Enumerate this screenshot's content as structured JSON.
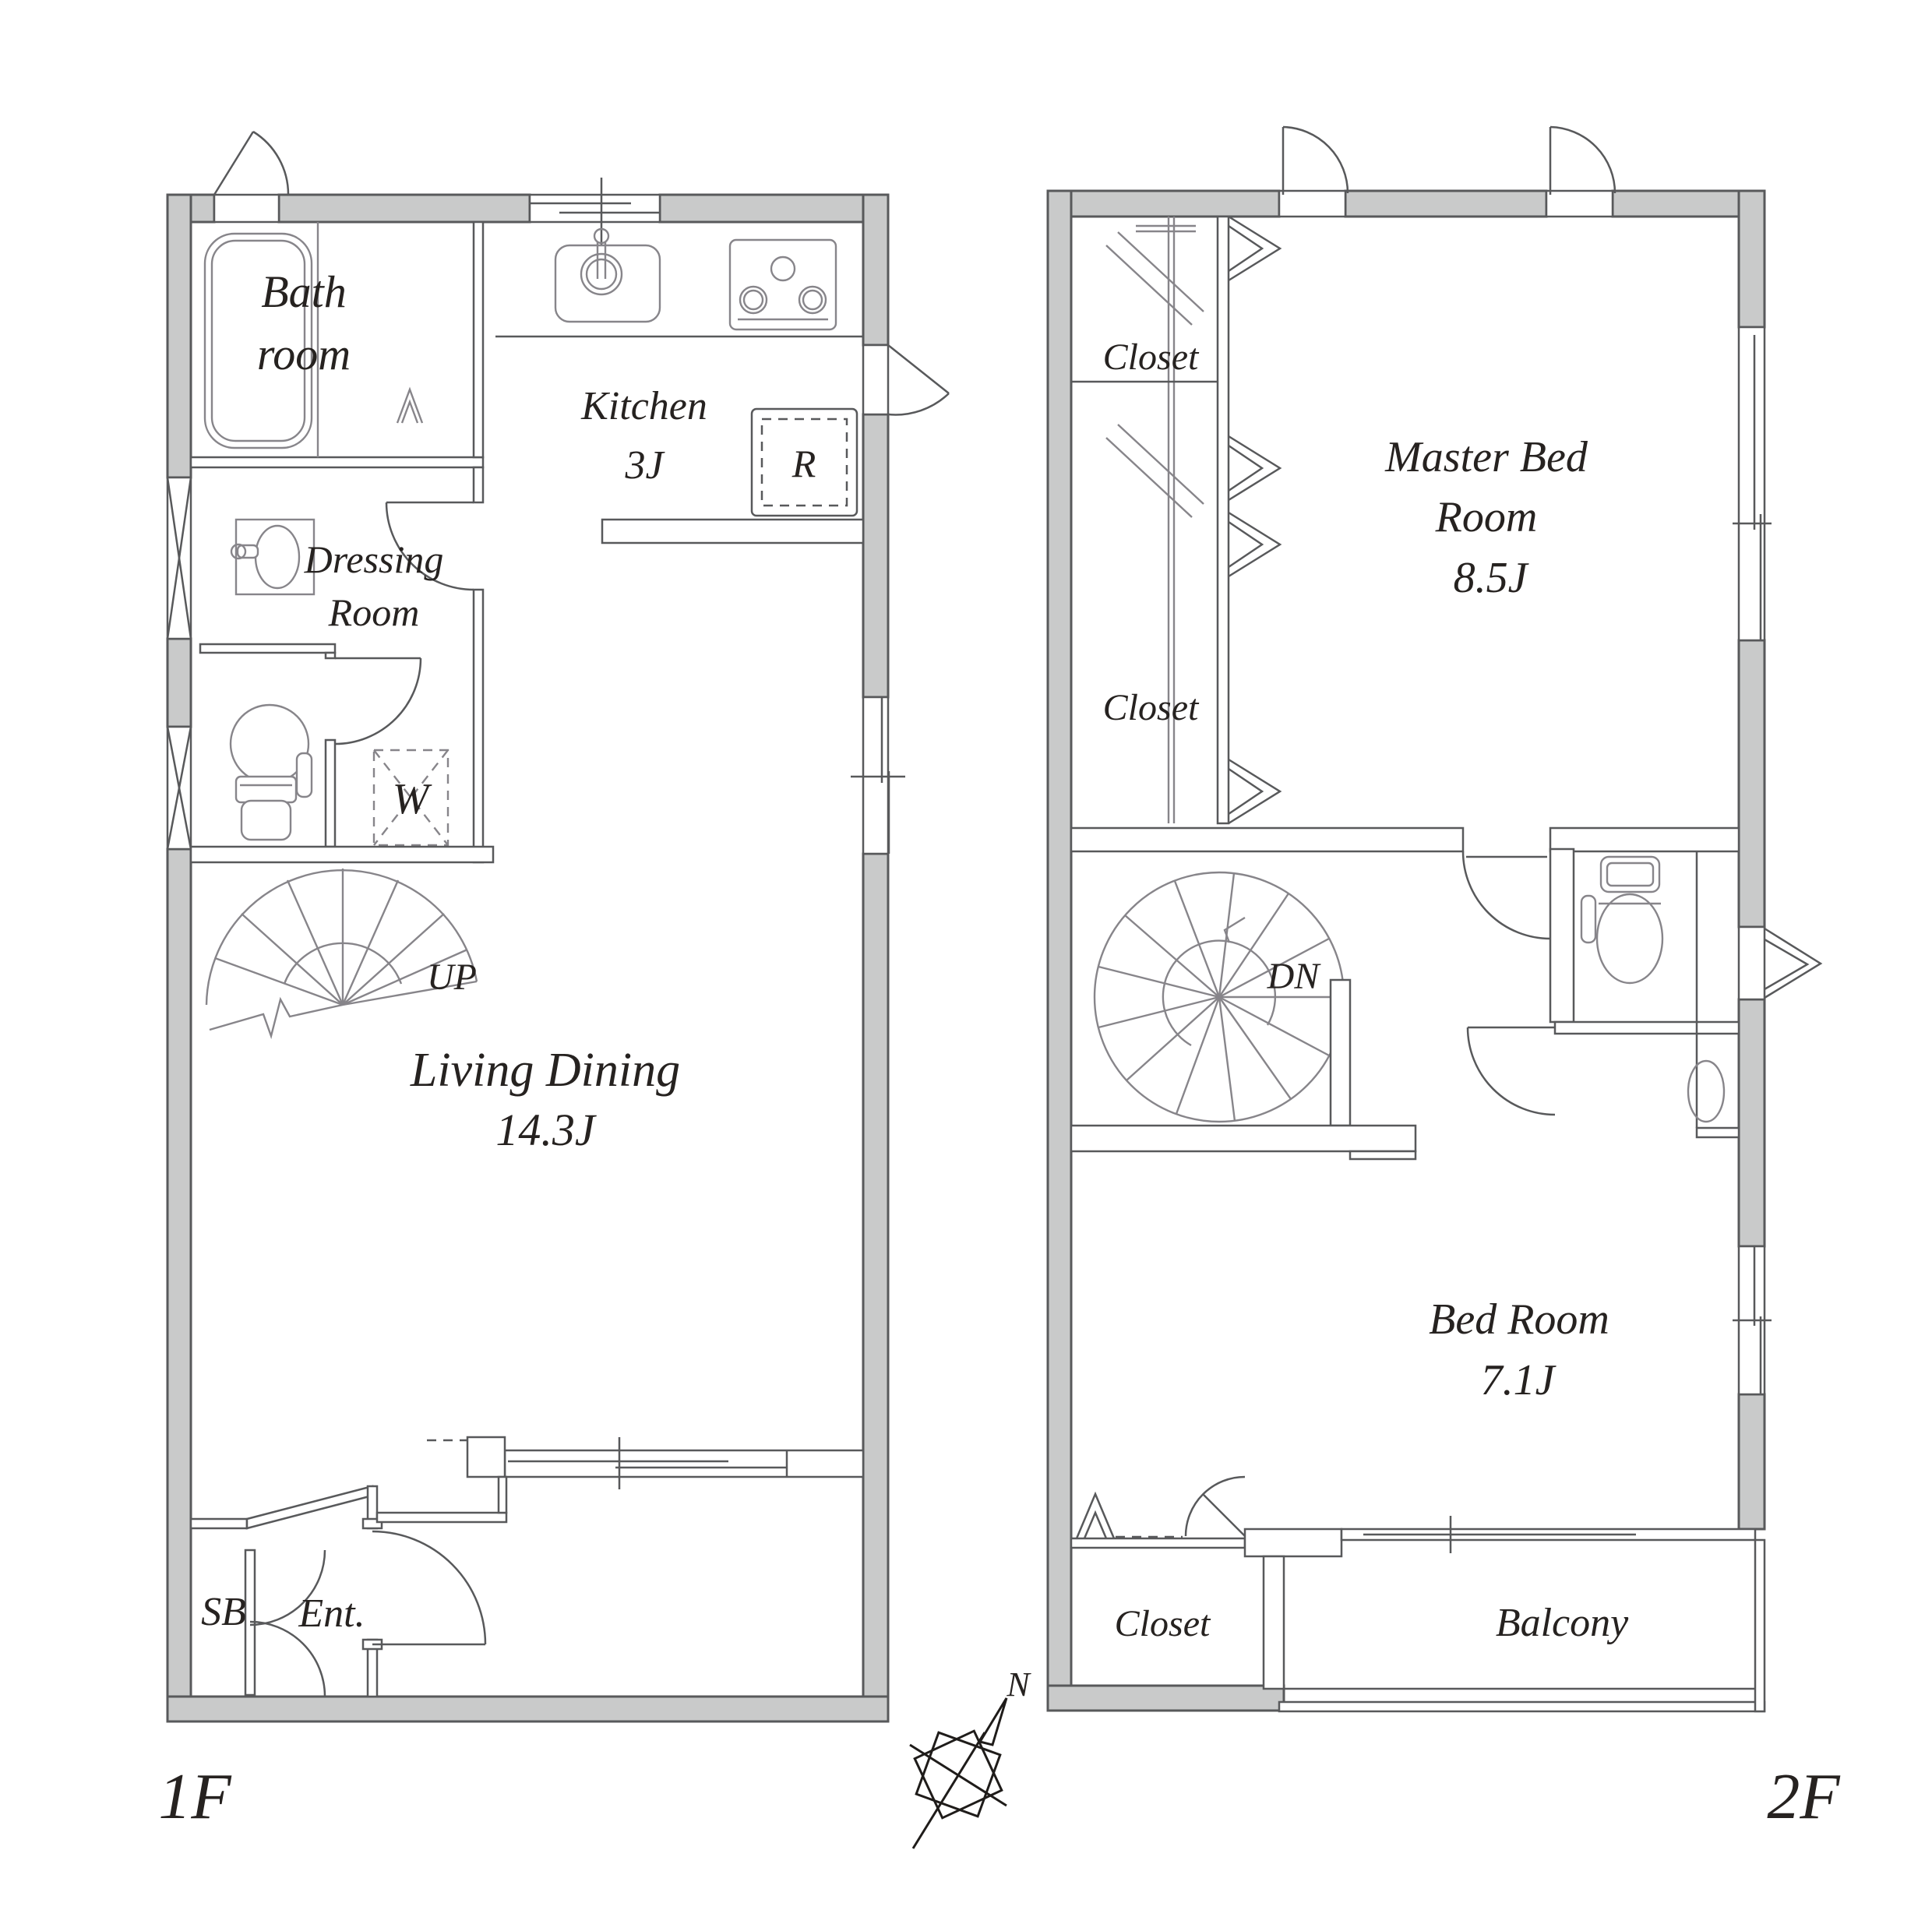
{
  "title": "Two-floor apartment floor plan",
  "floor1": {
    "floor_label": "1F",
    "bathroom_line1": "Bath",
    "bathroom_line2": "room",
    "kitchen_name": "Kitchen",
    "kitchen_size": "3J",
    "fridge_label": "R",
    "dressing_line1": "Dressing",
    "dressing_line2": "Room",
    "washer_label": "W",
    "stairs_label": "UP",
    "living_name": "Living Dining",
    "living_size": "14.3J",
    "shoebox_label": "SB",
    "entrance_label": "Ent."
  },
  "floor2": {
    "floor_label": "2F",
    "closet_upper1": "Closet",
    "closet_upper2": "Closet",
    "master_line1": "Master Bed",
    "master_line2": "Room",
    "master_size": "8.5J",
    "stairs_label": "DN",
    "bedroom_name": "Bed Room",
    "bedroom_size": "7.1J",
    "closet_lower": "Closet",
    "balcony_label": "Balcony"
  },
  "compass": {
    "north_label": "N"
  },
  "colors": {
    "wall_fill": "#c9caca",
    "wall_stroke": "#58595b",
    "fixture_stroke": "#87858a",
    "text_color": "#262220",
    "compass_stroke": "#1f1c1a"
  }
}
